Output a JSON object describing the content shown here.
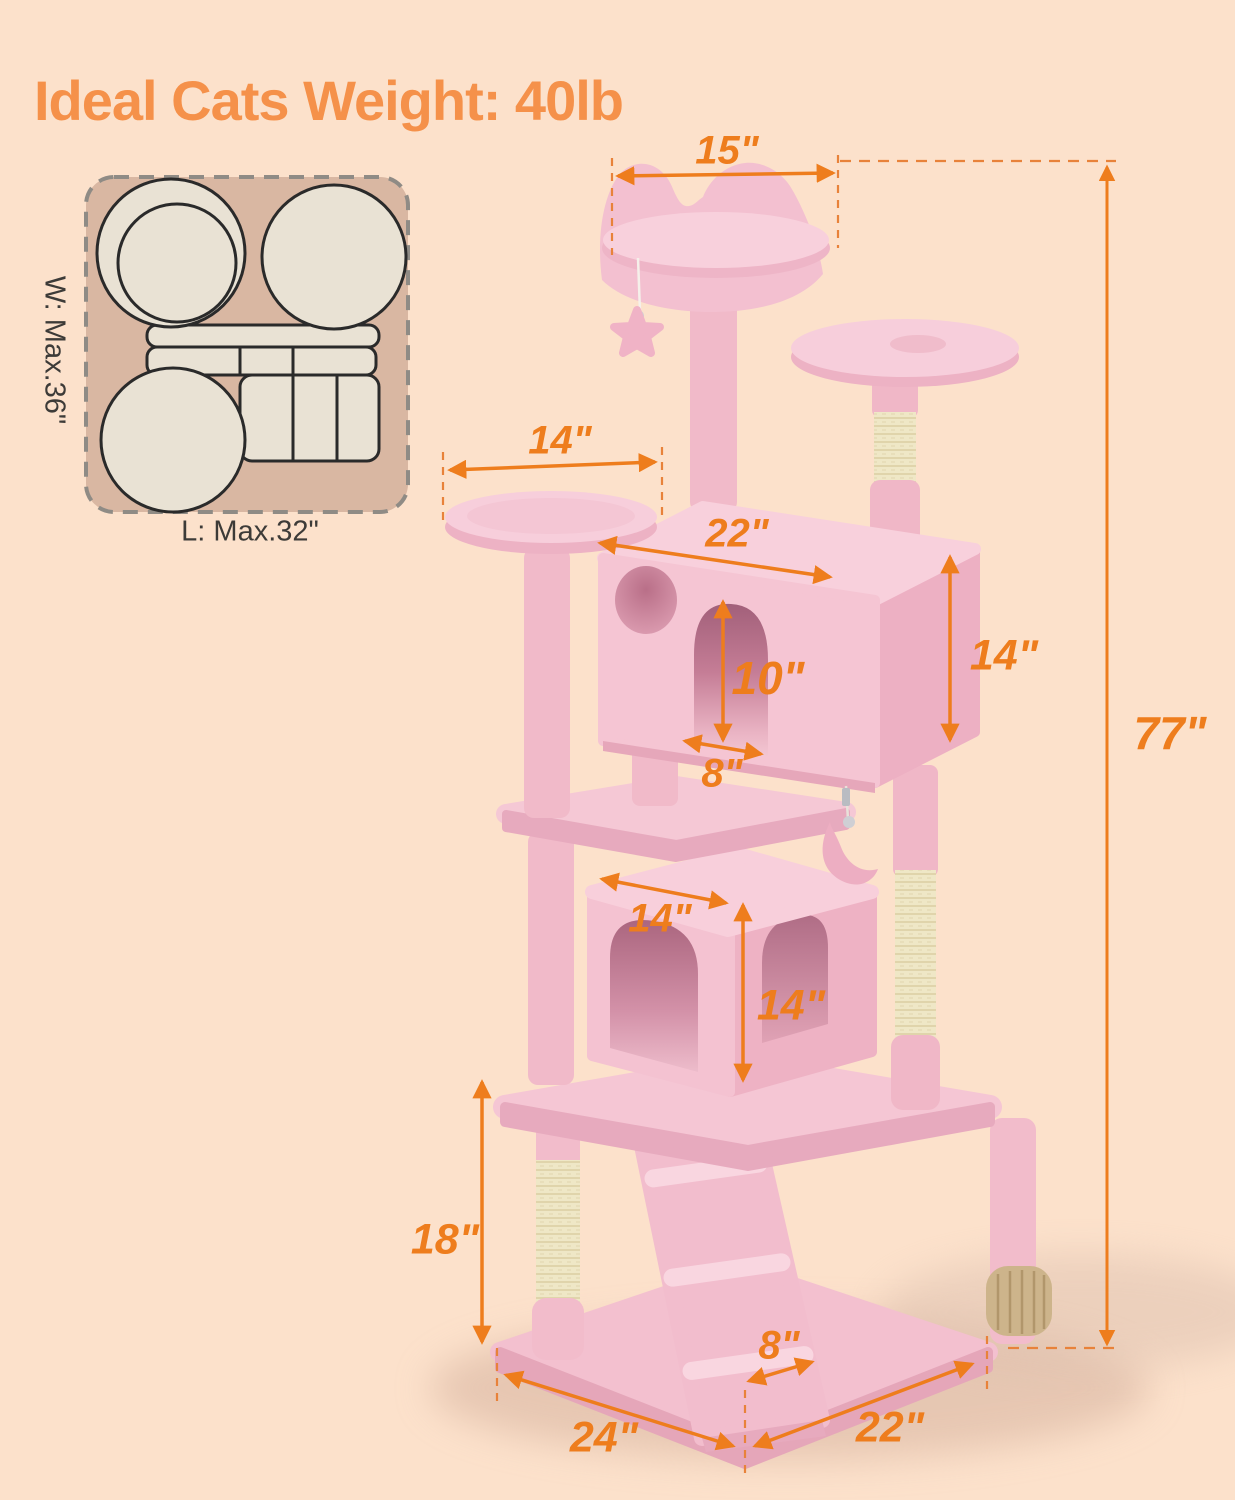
{
  "title": {
    "text": "Ideal Cats Weight: 40lb"
  },
  "footprint": {
    "width_label": "W: Max.36\"",
    "length_label": "L: Max.32\""
  },
  "dimensions": {
    "top_perch_width": "15\"",
    "left_platform_width": "14\"",
    "upper_condo_width": "22\"",
    "upper_condo_door_height": "10\"",
    "upper_condo_height": "14\"",
    "upper_condo_door_width": "8\"",
    "lower_condo_width": "14\"",
    "lower_condo_height": "14\"",
    "bottom_post_height": "18\"",
    "ramp_width": "8\"",
    "base_depth": "24\"",
    "base_width": "22\"",
    "total_height": "77\""
  },
  "colors": {
    "background": "#fce1cb",
    "accent_orange": "#ee7d1d",
    "title_orange": "#f5914a",
    "plush_pink": "#f5c6d3",
    "sisal_beige": "#efe7c6"
  }
}
